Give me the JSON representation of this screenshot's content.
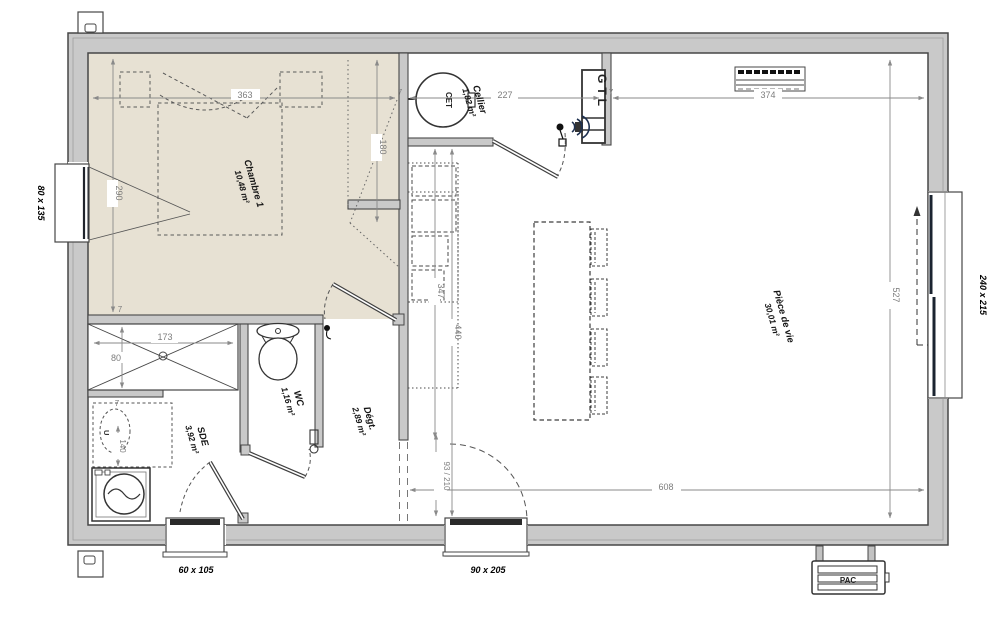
{
  "plan": {
    "rooms": {
      "chambre": {
        "name": "Chambre 1",
        "area": "10,48 m²"
      },
      "cellier": {
        "name": "Cellier",
        "area": "1,82 m²"
      },
      "piece_vie": {
        "name": "Pièce de vie",
        "area": "30,01 m²"
      },
      "wc": {
        "name": "WC",
        "area": "1,16 m²"
      },
      "sde": {
        "name": "SDE",
        "area": "3,92 m²"
      },
      "degagement": {
        "name": "Dégt.",
        "area": "2,89 m²"
      }
    },
    "dims": {
      "d363": "363",
      "d290": "290",
      "d180": "180",
      "d227": "227",
      "d374": "374",
      "d527": "527",
      "d608": "608",
      "d347": "347",
      "d440": "440",
      "d173": "173",
      "d80": "80",
      "d140": "140",
      "entry_door_size": "93 / 210",
      "wall": "7"
    },
    "openings": {
      "left_window": "80 x 135",
      "bay_window": "240 x 215",
      "sde_window": "60 x 105",
      "entry_door": "90 x 205"
    },
    "equipment": {
      "water_heater": "CET",
      "technical_box": "GTL",
      "heat_pump": "PAC",
      "sink": "U"
    },
    "colors": {
      "floor_beige": "#e7e1d3",
      "wall_fill": "#c9c9c9",
      "wall_stroke": "#474747",
      "dim_gray": "#8a8a8a",
      "label_black": "#111111"
    }
  }
}
